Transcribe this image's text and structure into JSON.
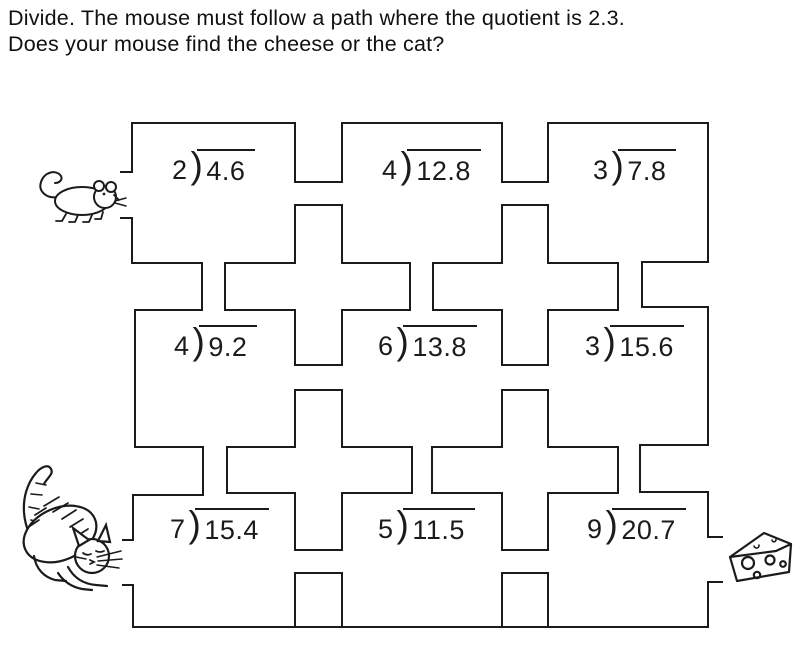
{
  "header": {
    "line1": "Divide. The mouse must follow a path where the quotient is 2.3.",
    "line2": "Does your mouse find the cheese or the cat?"
  },
  "glyphs": {
    "division_bracket": ")"
  },
  "problems": [
    {
      "divisor": "2",
      "dividend": "4.6"
    },
    {
      "divisor": "4",
      "dividend": "12.8"
    },
    {
      "divisor": "3",
      "dividend": "7.8"
    },
    {
      "divisor": "4",
      "dividend": "9.2"
    },
    {
      "divisor": "6",
      "dividend": "13.8"
    },
    {
      "divisor": "3",
      "dividend": "15.6"
    },
    {
      "divisor": "7",
      "dividend": "15.4"
    },
    {
      "divisor": "5",
      "dividend": "11.5"
    },
    {
      "divisor": "9",
      "dividend": "20.7"
    }
  ],
  "figures": {
    "start_icon": "mouse",
    "trap_icon": "cat",
    "goal_icon": "cheese"
  },
  "colors": {
    "ink": "#1b1b1b",
    "paper": "#ffffff"
  }
}
